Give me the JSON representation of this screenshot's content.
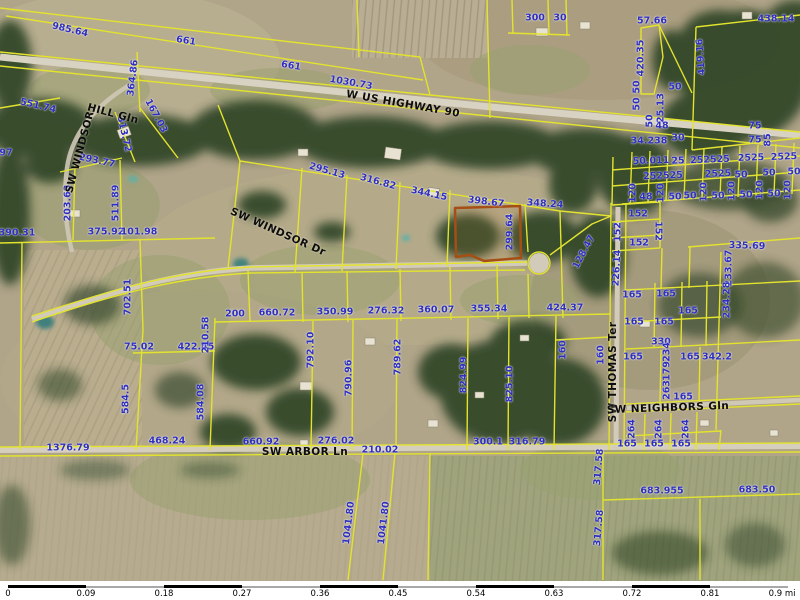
{
  "map": {
    "label_color": "#2f2fbe",
    "road_label_color": "#0d0d0d",
    "parcel_line_color": "#e3e32e",
    "highlight": {
      "outline_color": "#a64e14",
      "side_label": "299.64"
    },
    "road_labels": [
      {
        "t": "W US HIGHWAY 90",
        "x": 403,
        "y": 104,
        "r": 10
      },
      {
        "t": "HILL Gln",
        "x": 113,
        "y": 114,
        "r": 15
      },
      {
        "t": "SW WINDSOR",
        "x": 80,
        "y": 152,
        "r": -75
      },
      {
        "t": "SW WINDSOR Dr",
        "x": 278,
        "y": 232,
        "r": 24
      },
      {
        "t": "SW ARBOR Ln",
        "x": 305,
        "y": 452,
        "r": 0
      },
      {
        "t": "SW THOMAS Ter",
        "x": 613,
        "y": 372,
        "r": -90
      },
      {
        "t": "SW NEIGHBORS Gln",
        "x": 668,
        "y": 408,
        "r": -2
      }
    ],
    "dimension_labels": [
      {
        "t": "985.64",
        "x": 70,
        "y": 30,
        "r": 13
      },
      {
        "t": "661",
        "x": 186,
        "y": 41,
        "r": 9
      },
      {
        "t": "661",
        "x": 291,
        "y": 66,
        "r": 9
      },
      {
        "t": "364.86",
        "x": 133,
        "y": 78,
        "r": -83
      },
      {
        "t": "1030.73",
        "x": 351,
        "y": 83,
        "r": 10
      },
      {
        "t": "300",
        "x": 535,
        "y": 18,
        "r": 0
      },
      {
        "t": "30",
        "x": 560,
        "y": 18,
        "r": 0
      },
      {
        "t": "57.66",
        "x": 652,
        "y": 21,
        "r": 0
      },
      {
        "t": "438.14",
        "x": 776,
        "y": 19,
        "r": 0
      },
      {
        "t": "420.35",
        "x": 641,
        "y": 58,
        "r": -90
      },
      {
        "t": "419.16",
        "x": 701,
        "y": 57,
        "r": -94
      },
      {
        "t": "551.74",
        "x": 38,
        "y": 106,
        "r": 13
      },
      {
        "t": "167.03",
        "x": 156,
        "y": 116,
        "r": 62
      },
      {
        "t": "313.72",
        "x": 124,
        "y": 134,
        "r": 77
      },
      {
        "t": "293.77",
        "x": 97,
        "y": 161,
        "r": 12
      },
      {
        "t": "97",
        "x": 6,
        "y": 153,
        "r": 0
      },
      {
        "t": "203.63",
        "x": 68,
        "y": 203,
        "r": -90
      },
      {
        "t": "511.89",
        "x": 116,
        "y": 203,
        "r": -90
      },
      {
        "t": "390.31",
        "x": 17,
        "y": 233,
        "r": 0
      },
      {
        "t": "375.92",
        "x": 106,
        "y": 232,
        "r": 0
      },
      {
        "t": "101.98",
        "x": 139,
        "y": 232,
        "r": 0
      },
      {
        "t": "50",
        "x": 637,
        "y": 87,
        "r": -90
      },
      {
        "t": "50",
        "x": 637,
        "y": 104,
        "r": -90
      },
      {
        "t": "50",
        "x": 650,
        "y": 121,
        "r": -90
      },
      {
        "t": "25.13",
        "x": 661,
        "y": 108,
        "r": -90
      },
      {
        "t": "50",
        "x": 675,
        "y": 87,
        "r": 0
      },
      {
        "t": "48",
        "x": 662,
        "y": 126,
        "r": 0
      },
      {
        "t": "34.238",
        "x": 649,
        "y": 141,
        "r": 0
      },
      {
        "t": "30",
        "x": 678,
        "y": 138,
        "r": 0
      },
      {
        "t": "75",
        "x": 755,
        "y": 126,
        "r": 0
      },
      {
        "t": "75",
        "x": 755,
        "y": 140,
        "r": 0
      },
      {
        "t": "85",
        "x": 768,
        "y": 140,
        "r": -90
      },
      {
        "t": "50.011",
        "x": 651,
        "y": 161,
        "r": -2
      },
      {
        "t": "25",
        "x": 678,
        "y": 161,
        "r": -2
      },
      {
        "t": "252525",
        "x": 710,
        "y": 160,
        "r": -2
      },
      {
        "t": "2525",
        "x": 751,
        "y": 158,
        "r": -2
      },
      {
        "t": "2525",
        "x": 784,
        "y": 157,
        "r": -2
      },
      {
        "t": "252525",
        "x": 663,
        "y": 176,
        "r": -2
      },
      {
        "t": "2525",
        "x": 718,
        "y": 174,
        "r": -2
      },
      {
        "t": "50",
        "x": 741,
        "y": 175,
        "r": 0
      },
      {
        "t": "50",
        "x": 769,
        "y": 173,
        "r": 0
      },
      {
        "t": "50",
        "x": 794,
        "y": 172,
        "r": 0
      },
      {
        "t": "120",
        "x": 633,
        "y": 193,
        "r": -90
      },
      {
        "t": "48",
        "x": 646,
        "y": 197,
        "r": 0
      },
      {
        "t": "120",
        "x": 661,
        "y": 193,
        "r": -90
      },
      {
        "t": "50",
        "x": 675,
        "y": 197,
        "r": 0
      },
      {
        "t": "50",
        "x": 690,
        "y": 196,
        "r": 0
      },
      {
        "t": "120",
        "x": 704,
        "y": 192,
        "r": -90
      },
      {
        "t": "50",
        "x": 718,
        "y": 196,
        "r": 0
      },
      {
        "t": "120",
        "x": 732,
        "y": 191,
        "r": -90
      },
      {
        "t": "50",
        "x": 746,
        "y": 195,
        "r": 0
      },
      {
        "t": "120",
        "x": 760,
        "y": 190,
        "r": -90
      },
      {
        "t": "50",
        "x": 774,
        "y": 194,
        "r": 0
      },
      {
        "t": "120",
        "x": 788,
        "y": 190,
        "r": -90
      },
      {
        "t": "152",
        "x": 638,
        "y": 214,
        "r": 0
      },
      {
        "t": "152",
        "x": 618,
        "y": 232,
        "r": -90
      },
      {
        "t": "152",
        "x": 658,
        "y": 231,
        "r": 90
      },
      {
        "t": "152",
        "x": 639,
        "y": 243,
        "r": 0
      },
      {
        "t": "226.14",
        "x": 617,
        "y": 268,
        "r": -87
      },
      {
        "t": "128.47",
        "x": 584,
        "y": 252,
        "r": -62
      },
      {
        "t": "295.13",
        "x": 327,
        "y": 171,
        "r": 16
      },
      {
        "t": "316.82",
        "x": 378,
        "y": 182,
        "r": 15
      },
      {
        "t": "344.15",
        "x": 429,
        "y": 194,
        "r": 12
      },
      {
        "t": "398.67",
        "x": 486,
        "y": 202,
        "r": 7
      },
      {
        "t": "348.24",
        "x": 545,
        "y": 204,
        "r": 4
      },
      {
        "t": "299.64",
        "x": 510,
        "y": 232,
        "r": -90
      },
      {
        "t": "200",
        "x": 235,
        "y": 314,
        "r": 0
      },
      {
        "t": "660.72",
        "x": 277,
        "y": 313,
        "r": 0
      },
      {
        "t": "350.99",
        "x": 335,
        "y": 312,
        "r": 0
      },
      {
        "t": "276.32",
        "x": 386,
        "y": 311,
        "r": 0
      },
      {
        "t": "360.07",
        "x": 436,
        "y": 310,
        "r": 0
      },
      {
        "t": "355.34",
        "x": 489,
        "y": 309,
        "r": 0
      },
      {
        "t": "424.37",
        "x": 565,
        "y": 308,
        "r": 0
      },
      {
        "t": "702.51",
        "x": 128,
        "y": 297,
        "r": -90
      },
      {
        "t": "75.02",
        "x": 139,
        "y": 347,
        "r": 0
      },
      {
        "t": "422.45",
        "x": 196,
        "y": 347,
        "r": 0
      },
      {
        "t": "210.58",
        "x": 206,
        "y": 335,
        "r": -90
      },
      {
        "t": "584.5",
        "x": 126,
        "y": 399,
        "r": -90
      },
      {
        "t": "584.08",
        "x": 201,
        "y": 402,
        "r": -90
      },
      {
        "t": "792.10",
        "x": 311,
        "y": 350,
        "r": -90
      },
      {
        "t": "790.96",
        "x": 349,
        "y": 378,
        "r": -90
      },
      {
        "t": "789.62",
        "x": 398,
        "y": 357,
        "r": -90
      },
      {
        "t": "824.99",
        "x": 464,
        "y": 375,
        "r": -90
      },
      {
        "t": "825.10",
        "x": 510,
        "y": 384,
        "r": -90
      },
      {
        "t": "160",
        "x": 563,
        "y": 350,
        "r": -90
      },
      {
        "t": "160",
        "x": 601,
        "y": 355,
        "r": -90
      },
      {
        "t": "335.69",
        "x": 747,
        "y": 246,
        "r": 2
      },
      {
        "t": "233.67",
        "x": 729,
        "y": 268,
        "r": -90
      },
      {
        "t": "234.28",
        "x": 727,
        "y": 300,
        "r": -90
      },
      {
        "t": "165",
        "x": 632,
        "y": 295,
        "r": 0
      },
      {
        "t": "165",
        "x": 666,
        "y": 294,
        "r": 0
      },
      {
        "t": "165",
        "x": 688,
        "y": 311,
        "r": 0
      },
      {
        "t": "165",
        "x": 634,
        "y": 322,
        "r": 0
      },
      {
        "t": "165",
        "x": 664,
        "y": 322,
        "r": 0
      },
      {
        "t": "330",
        "x": 661,
        "y": 342,
        "r": 0
      },
      {
        "t": "165",
        "x": 633,
        "y": 357,
        "r": 0
      },
      {
        "t": "165",
        "x": 690,
        "y": 357,
        "r": 0
      },
      {
        "t": "342.2",
        "x": 717,
        "y": 357,
        "r": 0
      },
      {
        "t": "234",
        "x": 667,
        "y": 352,
        "r": -90
      },
      {
        "t": "179",
        "x": 667,
        "y": 371,
        "r": -90
      },
      {
        "t": "263",
        "x": 667,
        "y": 390,
        "r": -90
      },
      {
        "t": "165",
        "x": 683,
        "y": 397,
        "r": 0
      },
      {
        "t": "264",
        "x": 632,
        "y": 429,
        "r": -90
      },
      {
        "t": "264",
        "x": 659,
        "y": 429,
        "r": -90
      },
      {
        "t": "264",
        "x": 686,
        "y": 429,
        "r": -90
      },
      {
        "t": "165",
        "x": 627,
        "y": 444,
        "r": 0
      },
      {
        "t": "165",
        "x": 654,
        "y": 444,
        "r": 0
      },
      {
        "t": "165",
        "x": 681,
        "y": 444,
        "r": 0
      },
      {
        "t": "1376.79",
        "x": 68,
        "y": 448,
        "r": 0
      },
      {
        "t": "468.24",
        "x": 167,
        "y": 441,
        "r": 0
      },
      {
        "t": "660.92",
        "x": 261,
        "y": 442,
        "r": 0
      },
      {
        "t": "276.02",
        "x": 336,
        "y": 441,
        "r": 0
      },
      {
        "t": "210.02",
        "x": 380,
        "y": 450,
        "r": 0
      },
      {
        "t": "300.1",
        "x": 488,
        "y": 442,
        "r": 0
      },
      {
        "t": "316.79",
        "x": 527,
        "y": 442,
        "r": 0
      },
      {
        "t": "317.58",
        "x": 599,
        "y": 467,
        "r": -85
      },
      {
        "t": "317.58",
        "x": 599,
        "y": 528,
        "r": -85
      },
      {
        "t": "683.955",
        "x": 662,
        "y": 491,
        "r": 0
      },
      {
        "t": "683.50",
        "x": 757,
        "y": 490,
        "r": 0
      },
      {
        "t": "1041.80",
        "x": 349,
        "y": 523,
        "r": -83
      },
      {
        "t": "1041.80",
        "x": 384,
        "y": 523,
        "r": -83
      }
    ]
  },
  "scale_bar": {
    "ticks": [
      "0",
      "0.09",
      "0.18",
      "0.27",
      "0.36",
      "0.45",
      "0.54",
      "0.63",
      "0.72",
      "0.81",
      "0.9 mi"
    ],
    "dark_color": "#000000",
    "light_color": "#a8a8a8"
  }
}
